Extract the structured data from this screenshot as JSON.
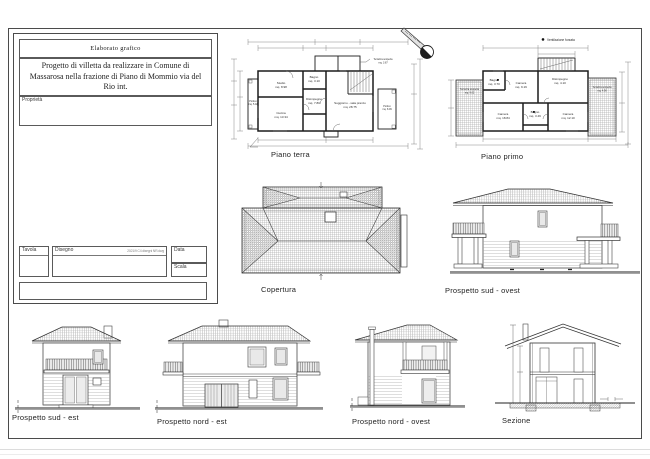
{
  "title_block": {
    "header": "Elaborato grafico",
    "project": "Progetto di villetta da realizzare in Comune di Massarosa nella frazione di Piano di Mommio via del Rio int.",
    "owner_label": "Proprietà",
    "tavola_label": "Tavola",
    "disegno_label": "Disegno",
    "file_note": "2021/9 C4 disegni NR.dwg",
    "data_label": "Data",
    "scala_label": "Scala"
  },
  "plans": {
    "piano_terra": {
      "label": "Piano terra",
      "rooms": [
        {
          "name": "Studio",
          "area": "mq. 8.98"
        },
        {
          "name": "Bagno",
          "area": "mq. 3.10"
        },
        {
          "name": "Disimpegno",
          "area": "mq. 7.80"
        },
        {
          "name": "Soggiorno - sala pranzo",
          "area": "mq. 28.75"
        },
        {
          "name": "Cucina",
          "area": "mq. 13.34"
        },
        {
          "name": "Portico",
          "area": "mq. 5.02"
        },
        {
          "name": "Portico",
          "area": "mq. 8.09"
        },
        {
          "name": "Terrazza scoperta",
          "area": "mq. 3.87"
        }
      ]
    },
    "piano_primo": {
      "label": "Piano primo",
      "legend": "Ventilazione forzata",
      "rooms": [
        {
          "name": "Bagno",
          "area": "mq. 3.70"
        },
        {
          "name": "Camera",
          "area": "mq. 9.19"
        },
        {
          "name": "Disimpegno",
          "area": "mq. 4.10"
        },
        {
          "name": "Camera",
          "area": "mq. 18.84"
        },
        {
          "name": "Bagno",
          "area": "mq. 3.49"
        },
        {
          "name": "Camera",
          "area": "mq. 12.10"
        },
        {
          "name": "Terrazza scoperta",
          "area": "mq. 9.02"
        },
        {
          "name": "Terrazza scoperta",
          "area": "mq. 4.90"
        }
      ]
    },
    "copertura": {
      "label": "Copertura"
    },
    "prospetto_sud_ovest": {
      "label": "Prospetto sud - ovest"
    },
    "prospetto_sud_est": {
      "label": "Prospetto sud - est"
    },
    "prospetto_nord_est": {
      "label": "Prospetto nord - est"
    },
    "prospetto_nord_ovest": {
      "label": "Prospetto nord - ovest"
    },
    "sezione": {
      "label": "Sezione"
    }
  }
}
